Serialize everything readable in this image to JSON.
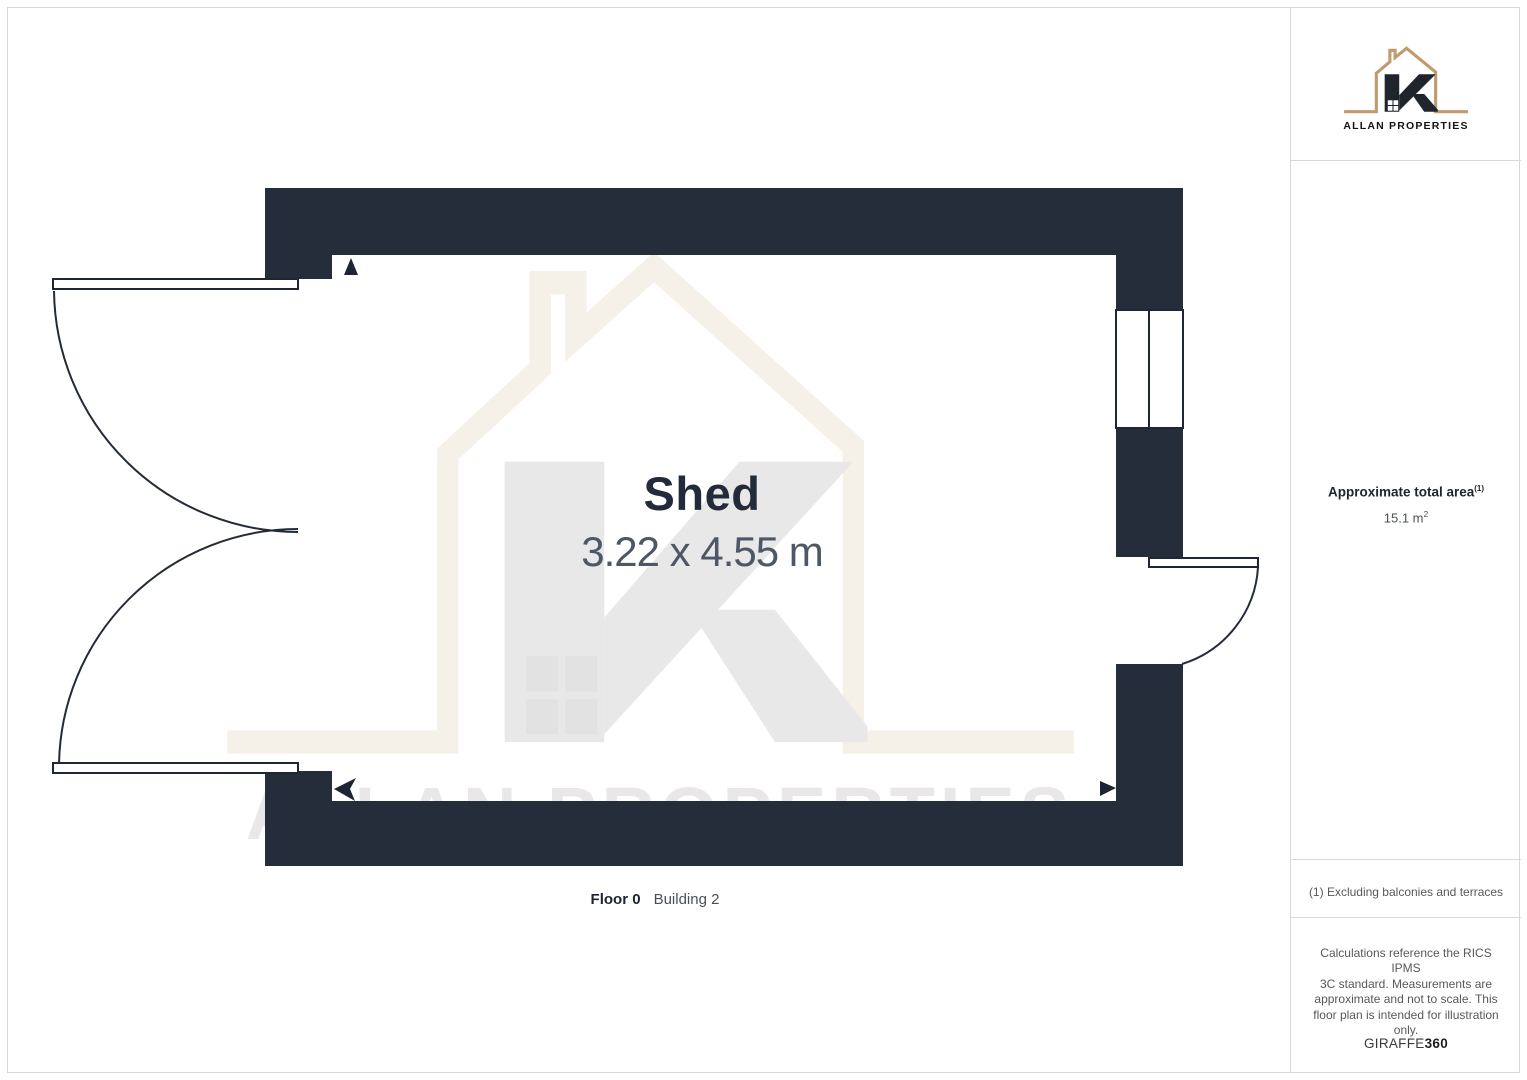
{
  "brand": {
    "name": "ALLAN PROPERTIES",
    "logo_tan": "#bf9b6f",
    "logo_dark": "#20242c"
  },
  "plan": {
    "room_name": "Shed",
    "room_dims": "3.22 x 4.55 m",
    "floor_label": "Floor 0",
    "building_label": "Building 2",
    "wall_color": "#1d2433"
  },
  "sidebar": {
    "area_title": "Approximate total area",
    "area_title_sup": "(1)",
    "area_value": "15.1 m",
    "area_value_sup": "2",
    "footnote": "(1) Excluding balconies and terraces",
    "disclaimer_lines": [
      "Calculations reference the RICS IPMS",
      "3C standard. Measurements are",
      "approximate and not to scale. This",
      "floor plan is intended for illustration",
      "only."
    ],
    "brand_suffix_normal": "GIRAFFE",
    "brand_suffix_bold": "360"
  },
  "watermark": {
    "house_beige": "#f6f1e8",
    "letter_gray": "#e9e7e7"
  }
}
